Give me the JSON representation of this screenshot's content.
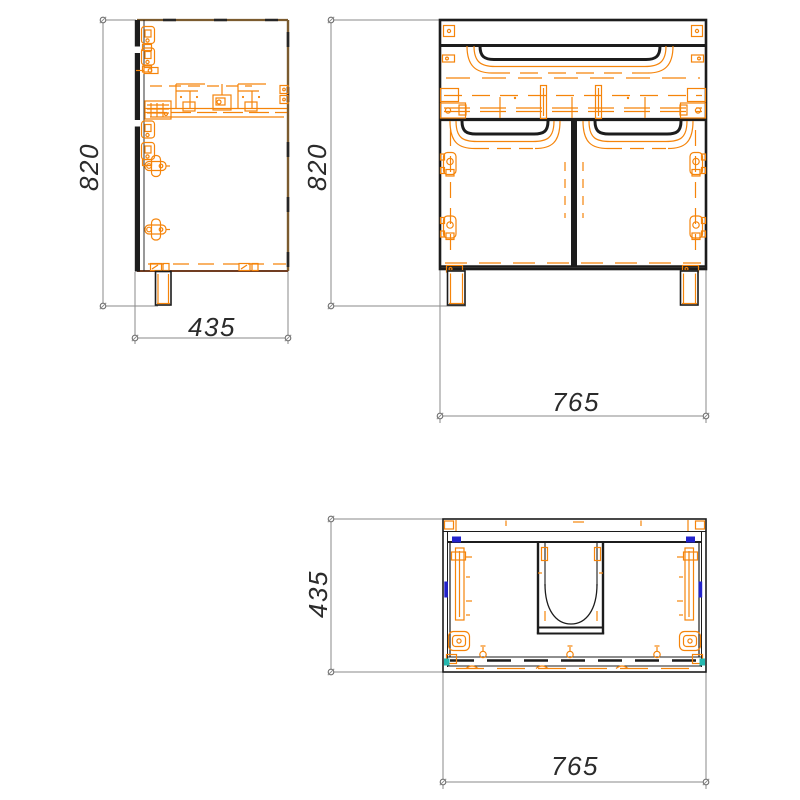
{
  "drawing": {
    "background": "#ffffff",
    "views": {
      "side": {
        "height": "820",
        "depth": "435"
      },
      "front": {
        "height": "820",
        "width": "765"
      },
      "top": {
        "depth": "435",
        "width": "765"
      }
    },
    "colors": {
      "outline": "#1c1c1c",
      "hardware_orange": "#f5840a",
      "edge_brown": "#7b5b2f",
      "edge_maroon": "#713d22",
      "dimension_gray": "#8a8a8a",
      "dimension_text": "#2b2b2b",
      "accent_blue": "#2222cc",
      "accent_teal": "#25b8b0"
    }
  }
}
